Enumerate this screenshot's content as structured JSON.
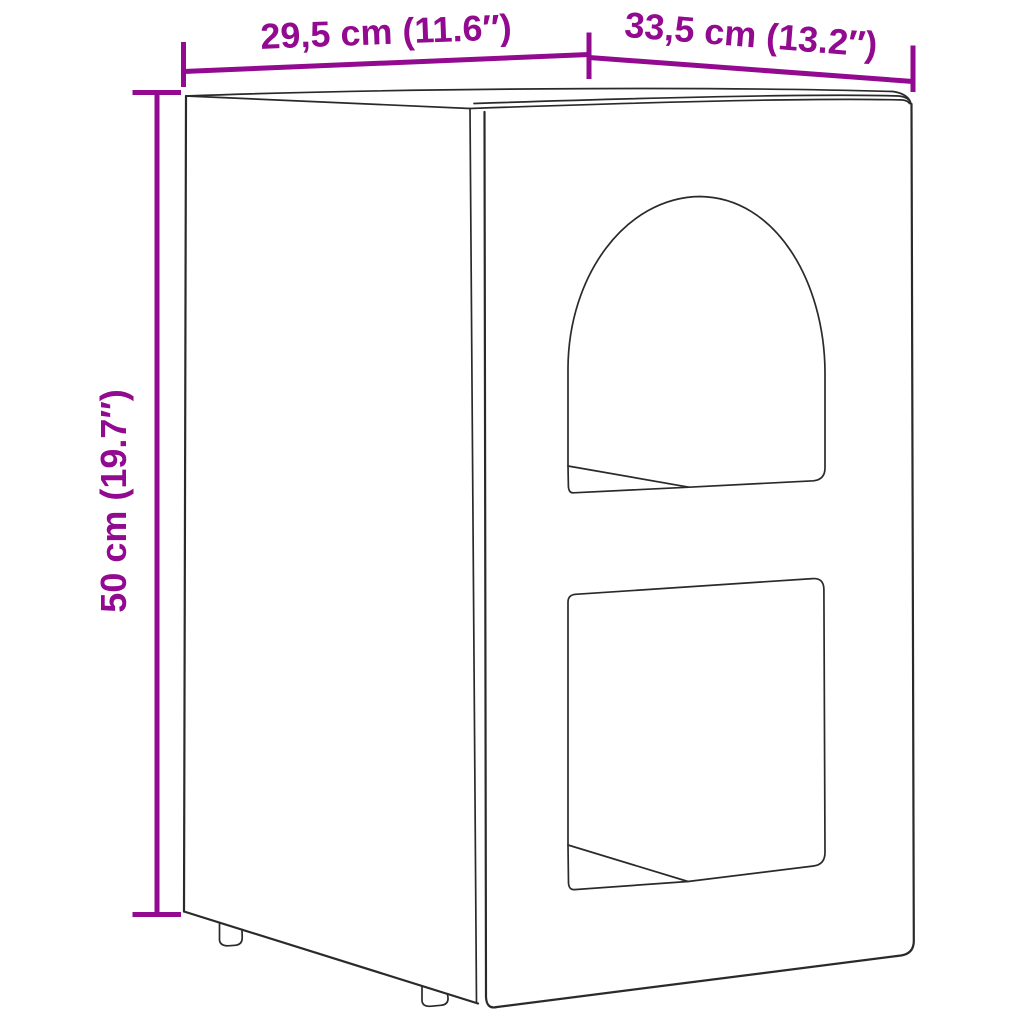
{
  "diagram": {
    "type": "furniture-dimension-line-drawing",
    "background": "#ffffff",
    "line_color": "#2a2a2a",
    "accent_color": "#910a8f",
    "dimensions": {
      "top_left": "29,5 cm (11.6″)",
      "top_right": "33,5 cm (13.2″)",
      "height": "50 cm (19.7″)"
    }
  }
}
